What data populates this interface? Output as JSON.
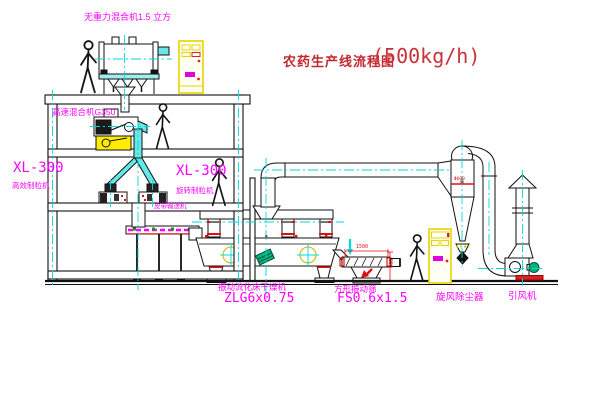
{
  "title": {
    "name": "农药生产线流程图",
    "capacity": "(500kg/h)"
  },
  "labels": {
    "gravity_mixer": "无重力混合机1.5 立方",
    "high_speed_mixer": "高速混合机G350",
    "granulator_left": {
      "model": "XL-300",
      "name": "高效制粒机"
    },
    "granulator_right": {
      "model": "XL-300",
      "name": "旋转制粒机"
    },
    "belt_conveyor": "皮带输送机",
    "dryer": {
      "name": "振动流化床干燥机",
      "model": "ZLG6x0.75"
    },
    "sieve": {
      "name": "方形振动筛",
      "model": "FS0.6x1.5"
    },
    "cyclone": "旋风除尘器",
    "induced_draft_fan": "引风机"
  },
  "dimensions": {
    "sieve_length": "1500",
    "sieve_height": "550",
    "cyclone_note": "Φ600"
  },
  "colors": {
    "label_magenta": "#ff00ff",
    "title_red": "#c22830",
    "dimension_red": "#e01010",
    "centerline_cyan": "#00d8d8",
    "cabinet_yellow": "#e8d400",
    "pipe_cyan": "#66e8e8",
    "motor_green": "#0ab27a",
    "line_black": "#111111"
  }
}
